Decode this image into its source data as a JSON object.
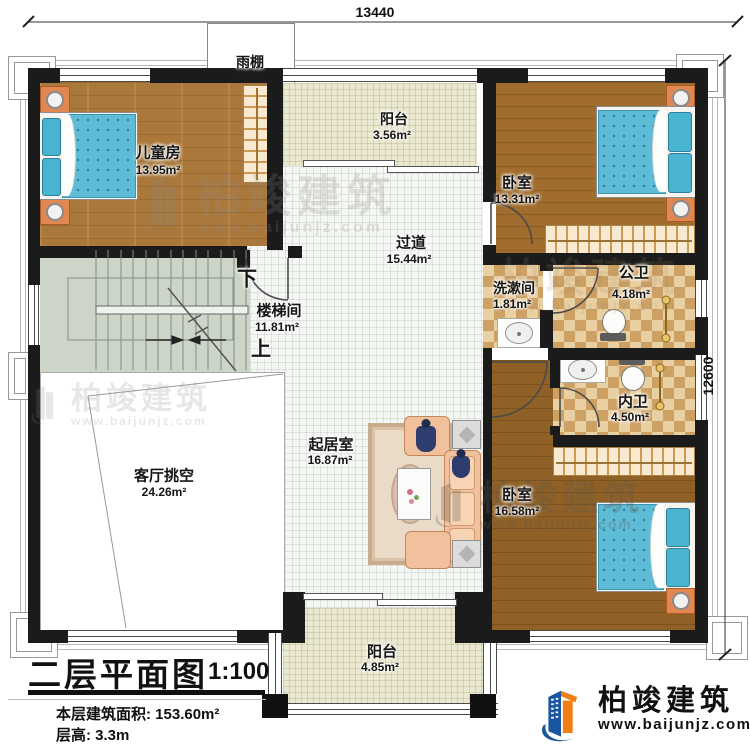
{
  "dimensions": {
    "top": "13440",
    "right": "12600"
  },
  "canopy_label": "雨棚",
  "rooms": [
    {
      "name": "儿童房",
      "area": "13.95m²"
    },
    {
      "name": "阳台",
      "area": "3.56m²"
    },
    {
      "name": "卧室",
      "area": "13.31m²"
    },
    {
      "name": "过道",
      "area": "15.44m²"
    },
    {
      "name": "楼梯间",
      "area": "11.81m²"
    },
    {
      "name": "洗漱间",
      "area": "1.81m²"
    },
    {
      "name": "公卫",
      "area": "4.18m²"
    },
    {
      "name": "内卫",
      "area": "4.50m²"
    },
    {
      "name": "起居室",
      "area": "16.87m²"
    },
    {
      "name": "客厅挑空",
      "area": "24.26m²"
    },
    {
      "name": "卧室",
      "area": "16.58m²"
    },
    {
      "name": "阳台",
      "area": "4.85m²"
    }
  ],
  "stairs": {
    "down_label": "下",
    "up_label": "上"
  },
  "title_block": {
    "title": "二层平面图",
    "scale": "1:100",
    "floor_area": "本层建筑面积: 153.60m²",
    "floor_height": "层高: 3.3m"
  },
  "brand": {
    "name": "柏竣建筑",
    "website": "www.baijunjz.com"
  },
  "watermark": {
    "name": "柏竣建筑",
    "website": "www.baijunjz.com"
  },
  "colors": {
    "wall": "#1b1b1b",
    "wood": "#ab783c",
    "tile": "#f5f7f4",
    "checker": "#cda064",
    "stair": "#ccd5c8",
    "balcony": "#ebe8d2",
    "bed": "#5fbcd6",
    "furniture_orange": "#e08752",
    "logo_blue": "#1a56a0",
    "logo_orange": "#f07f13"
  }
}
